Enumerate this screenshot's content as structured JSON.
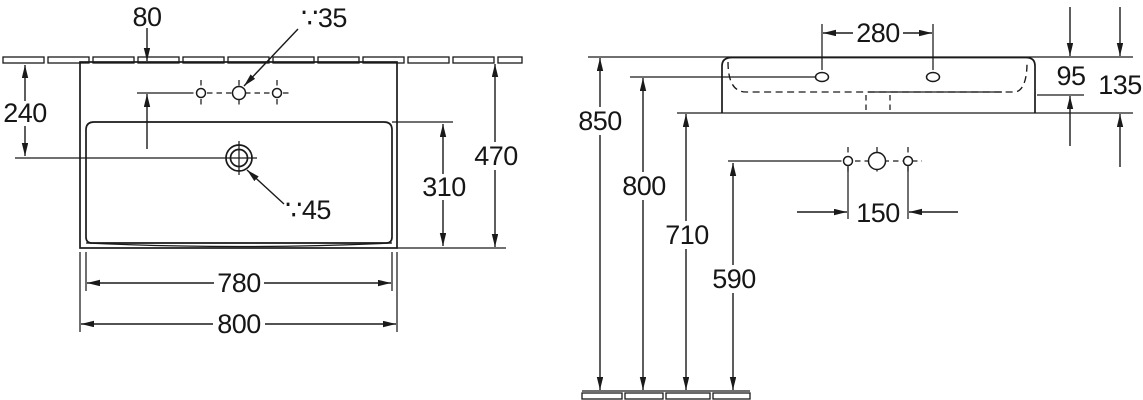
{
  "drawing": {
    "type": "washbasin installation dimension drawing",
    "units": "mm",
    "plan_view": {
      "faucet_offset": "80",
      "faucet_hole_dia": "∵35",
      "wall_to_drain": "240",
      "overall_depth": "470",
      "bowl_front_to_drain": "310",
      "drain_dia": "∵45",
      "inner_width": "780",
      "overall_width": "800"
    },
    "side_view": {
      "mounting_hole_spacing": "280",
      "rim_to_overflow": "95",
      "front_height": "135",
      "rim_height": "850",
      "mounting_height": "800",
      "underside_height": "710",
      "connection_height": "590",
      "connection_spacing": "150"
    }
  }
}
